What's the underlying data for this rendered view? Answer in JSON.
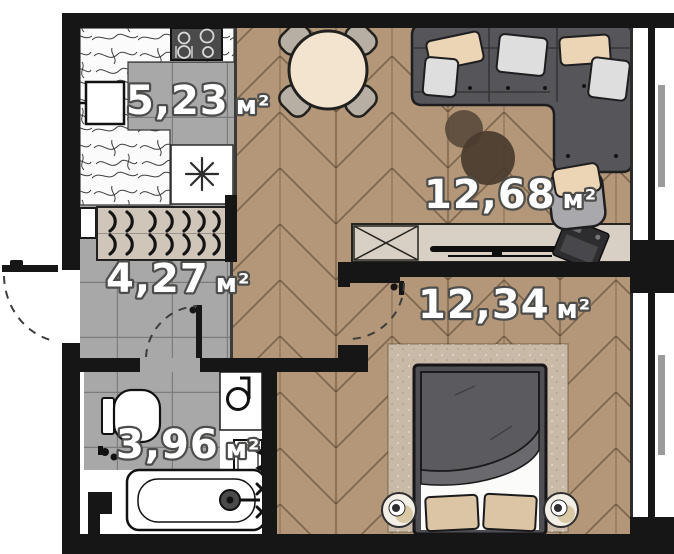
{
  "meta": {
    "type": "apartment-floor-plan"
  },
  "rooms": [
    {
      "id": "kitchen",
      "area_value": "5,23",
      "area_unit": "м²"
    },
    {
      "id": "hallway",
      "area_value": "4,27",
      "area_unit": "м²"
    },
    {
      "id": "living_room",
      "area_value": "12,68",
      "area_unit": "м²"
    },
    {
      "id": "bedroom",
      "area_value": "12,34",
      "area_unit": "м²"
    },
    {
      "id": "bathroom",
      "area_value": "3,96",
      "area_unit": "м²"
    }
  ],
  "colors": {
    "wall": "#161616",
    "wood_floor": "#b39778",
    "tile_floor": "#a8a8a8",
    "label_fill": "#ffffff",
    "label_outline": "#4d4d4b",
    "sofa": "#56565a",
    "rug": "#c9baa7",
    "wardrobe": "#cfc5b8",
    "console": "#d8d0c5",
    "pillow_beige": "#ecd5b4",
    "pillow_gray": "#dedede",
    "table_top": "#f2e4ce",
    "window_frame": "#161616",
    "glazing": "#9b9b9b"
  }
}
